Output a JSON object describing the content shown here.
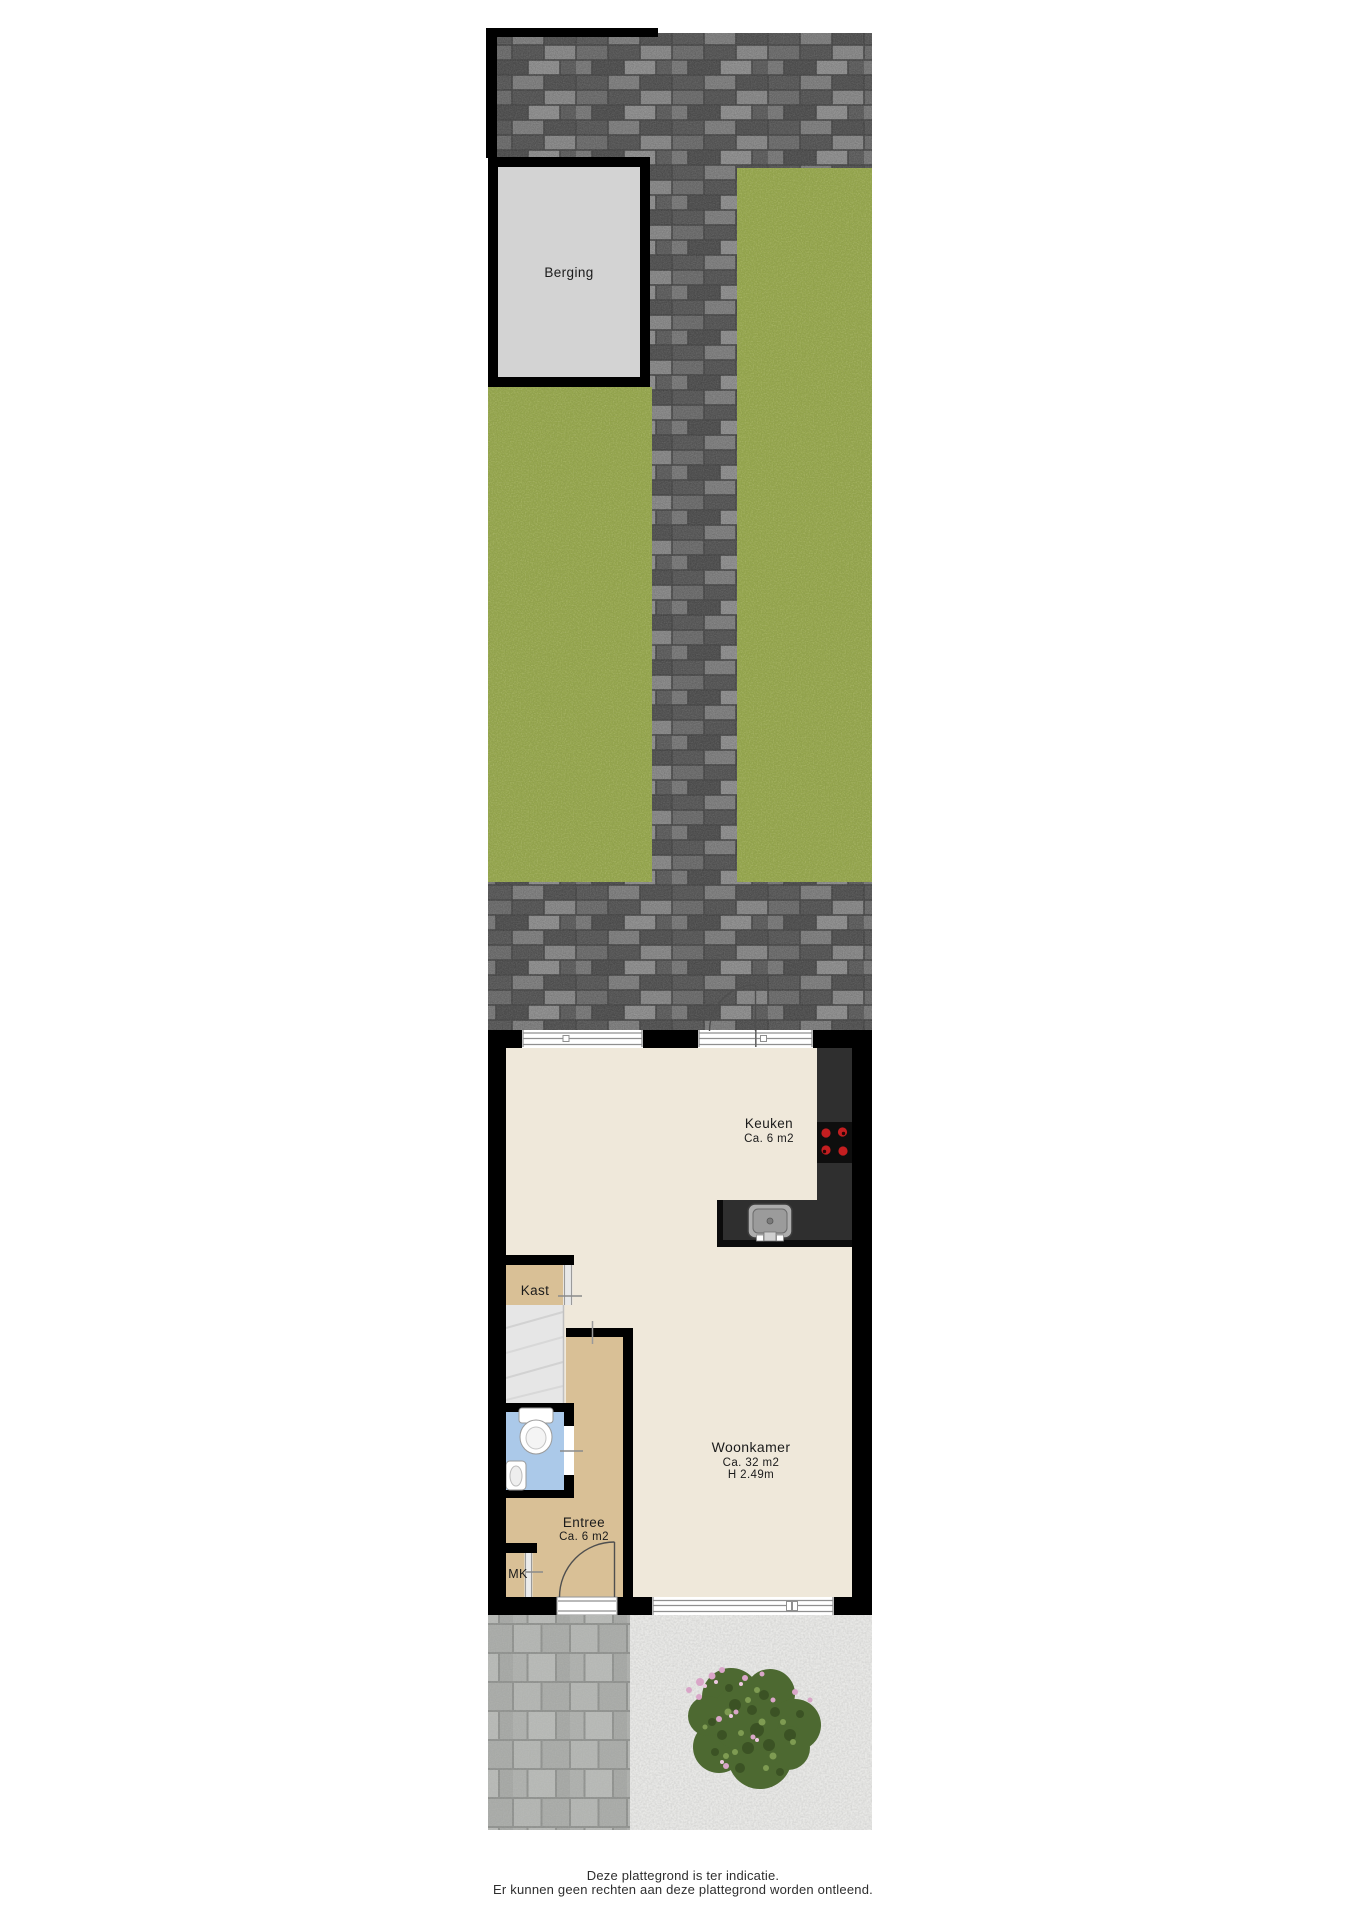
{
  "plan": {
    "shed": {
      "label": "Berging"
    },
    "rooms": {
      "kitchen": {
        "name": "Keuken",
        "area": "Ca. 6 m2"
      },
      "living_room": {
        "name": "Woonkamer",
        "area": "Ca. 32 m2",
        "ceiling_height": "H 2.49m"
      },
      "closet": {
        "name": "Kast"
      },
      "hallway": {
        "name": "Entree",
        "area": "Ca. 6 m2"
      },
      "meter_cupboard": {
        "name": "MK"
      }
    },
    "disclaimer": {
      "line1": "Deze plattegrond is ter indicatie.",
      "line2": "Er kunnen geen rechten aan deze plattegrond worden ontleend."
    },
    "colors": {
      "floor": "#efe8da",
      "hall_floor": "#d9c096",
      "toilet_floor": "#abc9e9",
      "shed_floor": "#d3d3d3",
      "grass": "#94a54c",
      "counter": "#2f2f2f",
      "burner_red": "#c41e20",
      "wall": "#000000"
    }
  }
}
